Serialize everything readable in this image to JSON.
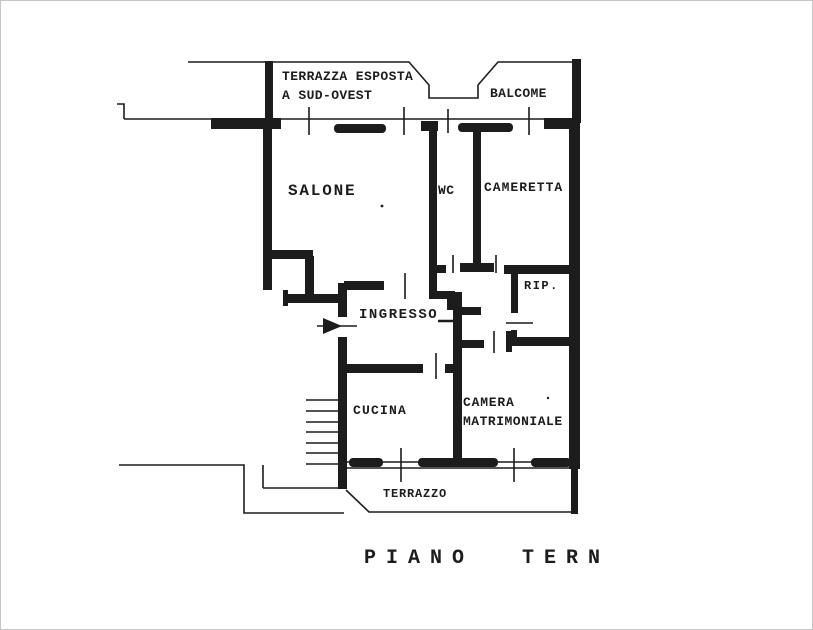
{
  "plan": {
    "title": "apartment floor plan (scanned)",
    "labels": {
      "terrazza_line1": "TERRAZZA ESPOSTA",
      "terrazza_line2": "A SUD-OVEST",
      "balcone": "BALCOME",
      "salone": "SALONE",
      "wc": "WC",
      "cameretta": "CAMERETTA",
      "ripostiglio": "RIP.",
      "ingresso": "INGRESSO",
      "cucina": "CUCINA",
      "camera_line1": "CAMERA",
      "camera_line2": "MATRIMONIALE",
      "terrazzo": "TERRAZZO",
      "floor_caption": "PIANO TERN"
    },
    "colors": {
      "ink": "#1c1c1c",
      "paper": "#ffffff",
      "frame_border": "#c5c5c5"
    }
  }
}
